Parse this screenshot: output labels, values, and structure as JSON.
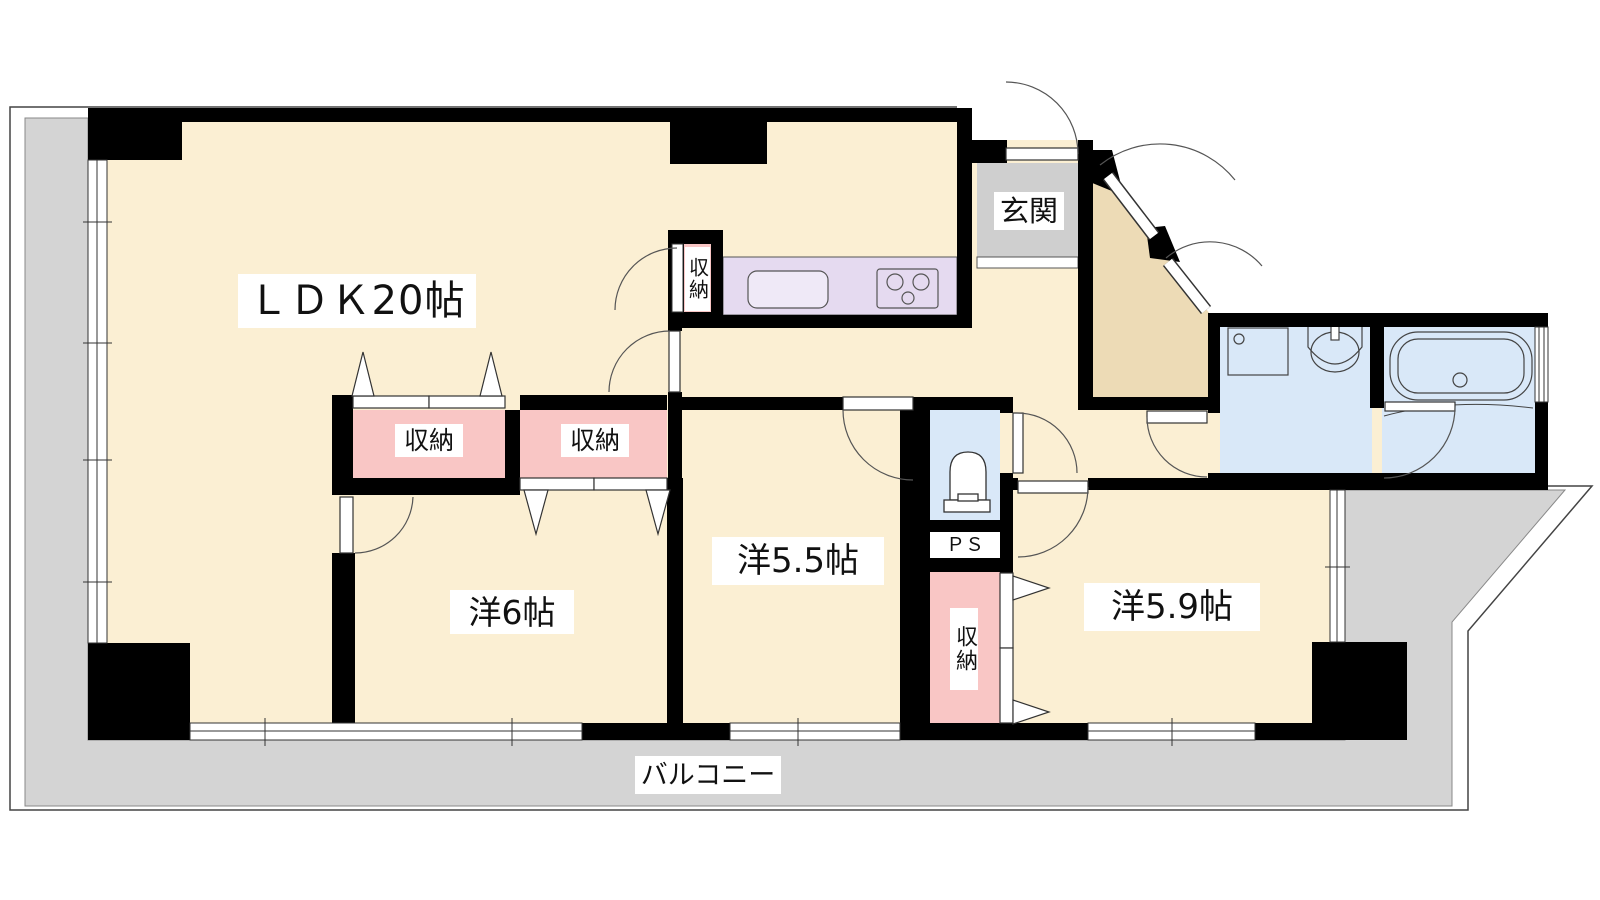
{
  "title": "apartment-floor-plan",
  "labels": {
    "ldk": "ＬＤＫ20帖",
    "genkan": "玄関",
    "closet": "収納",
    "room_west_6": "洋6帖",
    "room_west_55": "洋5.5帖",
    "room_west_59": "洋5.9帖",
    "ps": "ＰＳ",
    "balcony": "バルコニー"
  },
  "rooms": [
    {
      "name": "ldk",
      "label": "ＬＤＫ20帖"
    },
    {
      "name": "entrance",
      "label": "玄関"
    },
    {
      "name": "western-room-6",
      "label": "洋6帖"
    },
    {
      "name": "western-room-5-5",
      "label": "洋5.5帖"
    },
    {
      "name": "western-room-5-9",
      "label": "洋5.9帖"
    },
    {
      "name": "pipe-space",
      "label": "ＰＳ"
    },
    {
      "name": "balcony",
      "label": "バルコニー"
    },
    {
      "name": "closet",
      "label": "収納"
    }
  ],
  "colors": {
    "floor_cream": "#FBEFD3",
    "hall_tan": "#EDDBB6",
    "balcony_gray": "#D4D4D4",
    "entrance_gray": "#CFCFCF",
    "closet_pink": "#F9C6C5",
    "kitchen_purple": "#E5DAF0",
    "bath_blue": "#D9E8F8",
    "wall_black": "#000000",
    "line": "#333333",
    "fixture_fill": "#EFE9F7",
    "white": "#FFFFFF"
  }
}
